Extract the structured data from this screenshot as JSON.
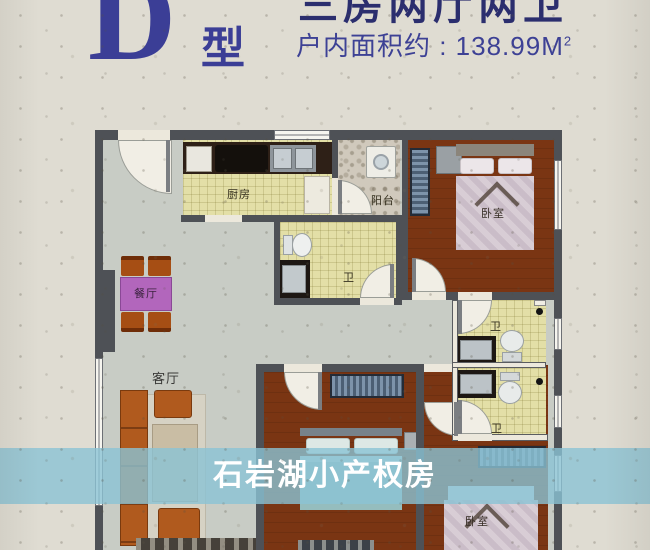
{
  "header": {
    "cutoff_text": "三房两厅两卫",
    "unit_letter": "D",
    "unit_type_suffix": "型",
    "area_text": "户内面积约 : 138.99M",
    "area_superscript": "2"
  },
  "watermark": {
    "text": "石岩湖小产权房"
  },
  "floorplan": {
    "labels": {
      "kitchen": "厨房",
      "balcony": "阳台",
      "dining": "餐厅",
      "living": "客厅",
      "bath": "卫",
      "bedroom": "卧室"
    }
  },
  "colors": {
    "title_blue": "#3b3e96",
    "banner_blue": "#8bc3d4",
    "wall_gray": "#4e5156",
    "floor_gray": "#c8ccc5",
    "tile_yellow": "#e3dfa7",
    "wood_brown": "#7a3513",
    "table_purple": "#b266bc",
    "sofa_orange": "#b05a1e",
    "paper_beige": "#dfdcd2"
  }
}
